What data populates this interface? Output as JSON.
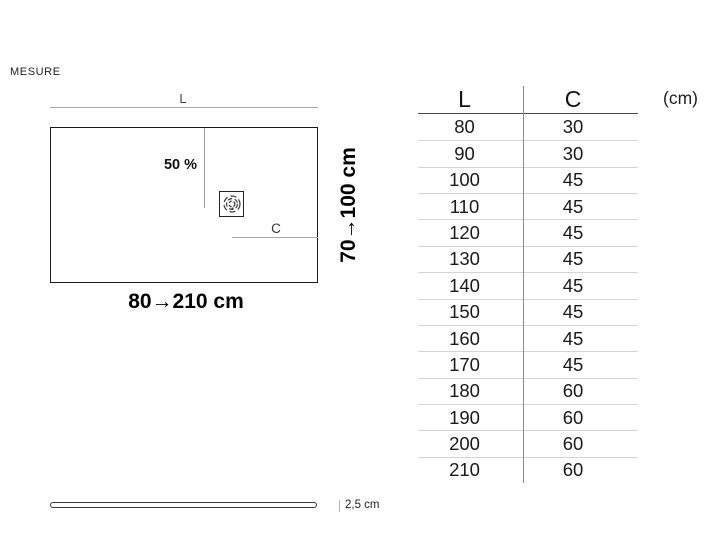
{
  "page": {
    "title": "MESURE"
  },
  "diagram": {
    "length_label": "L",
    "width_label": "C",
    "slope_label": "50 %",
    "length_range": "80→210 cm",
    "width_range": "70→100 cm"
  },
  "side_view": {
    "thickness_label": "2,5 cm"
  },
  "table": {
    "columns": [
      "L",
      "C"
    ],
    "unit": "(cm)",
    "rows": [
      [
        "80",
        "30"
      ],
      [
        "90",
        "30"
      ],
      [
        "100",
        "45"
      ],
      [
        "110",
        "45"
      ],
      [
        "120",
        "45"
      ],
      [
        "130",
        "45"
      ],
      [
        "140",
        "45"
      ],
      [
        "150",
        "45"
      ],
      [
        "160",
        "45"
      ],
      [
        "170",
        "45"
      ],
      [
        "180",
        "60"
      ],
      [
        "190",
        "60"
      ],
      [
        "200",
        "60"
      ],
      [
        "210",
        "60"
      ]
    ]
  },
  "colors": {
    "outline_dark": "#1a1a1a",
    "dimension_line_gray": "#a8a8a8",
    "row_separator": "#d4d4d4",
    "header_rule": "#4a4a4a",
    "text": "#111111"
  }
}
